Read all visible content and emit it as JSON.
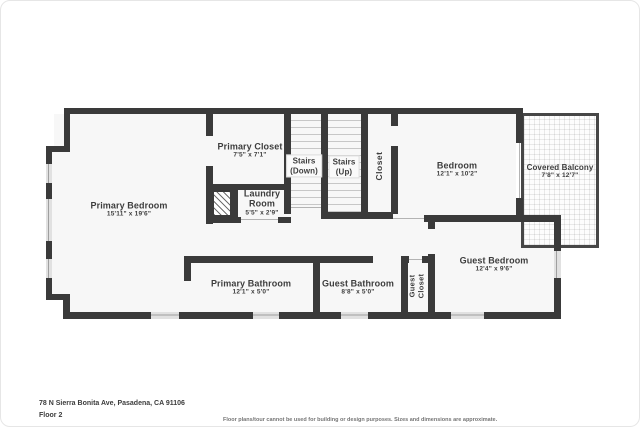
{
  "rooms": {
    "primary_bedroom": {
      "name": "Primary Bedroom",
      "dims": "15'11\" x 19'6\""
    },
    "primary_closet": {
      "name": "Primary Closet",
      "dims": "7'5\" x 7'1\""
    },
    "laundry_room": {
      "name": "Laundry Room",
      "dims": "5'5\" x 2'9\""
    },
    "stairs_down": {
      "line1": "Stairs",
      "line2": "(Down)"
    },
    "stairs_up": {
      "line1": "Stairs",
      "line2": "(Up)"
    },
    "closet": {
      "name": "Closet"
    },
    "bedroom": {
      "name": "Bedroom",
      "dims": "12'1\" x 10'2\""
    },
    "covered_balcony": {
      "name": "Covered Balcony",
      "dims": "7'8\" x 12'7\""
    },
    "guest_bedroom": {
      "name": "Guest Bedroom",
      "dims": "12'4\" x 9'6\""
    },
    "primary_bathroom": {
      "name": "Primary Bathroom",
      "dims": "12'1\" x 5'0\""
    },
    "guest_bathroom": {
      "name": "Guest Bathroom",
      "dims": "8'8\" x 5'0\""
    },
    "guest_closet": {
      "line1": "Guest",
      "line2": "Closet"
    }
  },
  "footer": {
    "address": "78 N Sierra Bonita Ave, Pasadena, CA 91106",
    "floor_label": "Floor 2",
    "disclaimer": "Floor plans/tour cannot be used for building or design purposes. Sizes and dimensions are approximate."
  },
  "colors": {
    "wall": "#3a3a3a",
    "room_fill": "#f7f7f7",
    "window": "#e1e1e1",
    "text": "#3d3d3d"
  }
}
